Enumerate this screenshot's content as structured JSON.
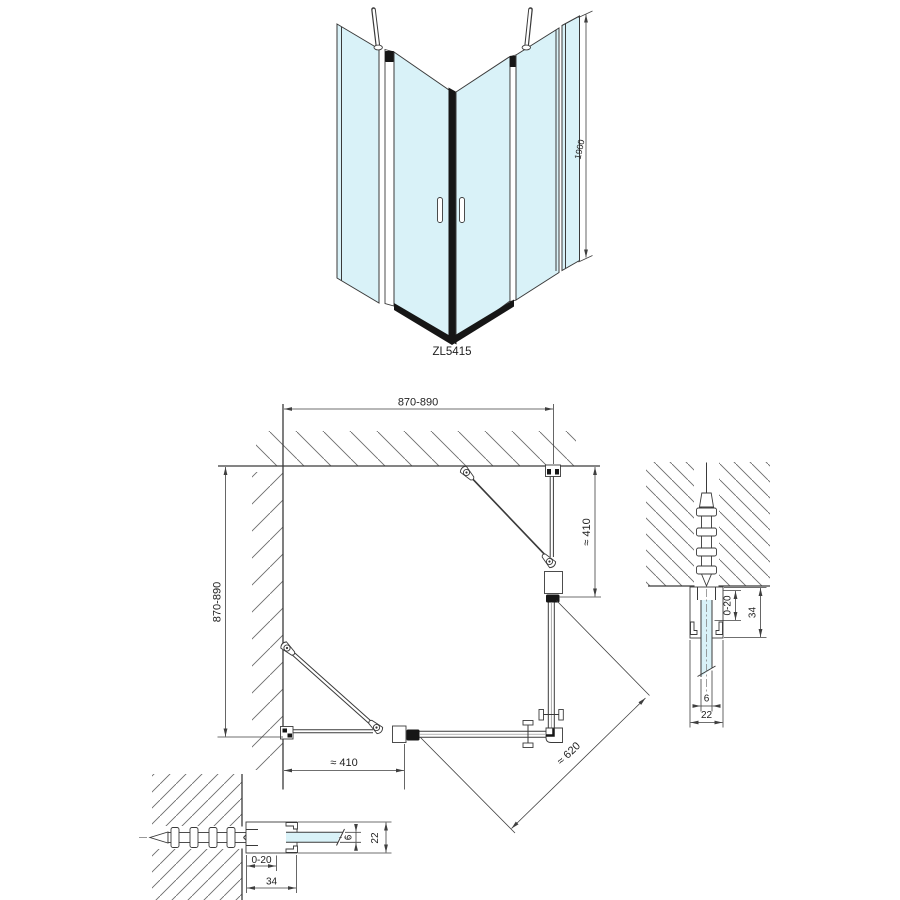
{
  "colors": {
    "background": "#ffffff",
    "glass": "#d9f2f8",
    "line": "#3a3a3a",
    "dark": "#161616",
    "dim": "#3f3f3f"
  },
  "product": {
    "code": "ZL5415"
  },
  "perspective_view": {
    "height_dim": "1900"
  },
  "plan_view": {
    "dim_width_top": "870-890",
    "dim_depth_left": "870-890",
    "dim_door_right": "≈ 410",
    "dim_door_bottom": "≈ 410",
    "dim_diagonal": "≈ 620"
  },
  "detail_right": {
    "adjustment": "0-20",
    "profile_depth": "34",
    "glass_thickness": "6",
    "profile_width": "22"
  },
  "detail_bottom": {
    "adjustment": "0-20",
    "profile_depth": "34",
    "glass_thickness": "6",
    "profile_width": "22"
  }
}
